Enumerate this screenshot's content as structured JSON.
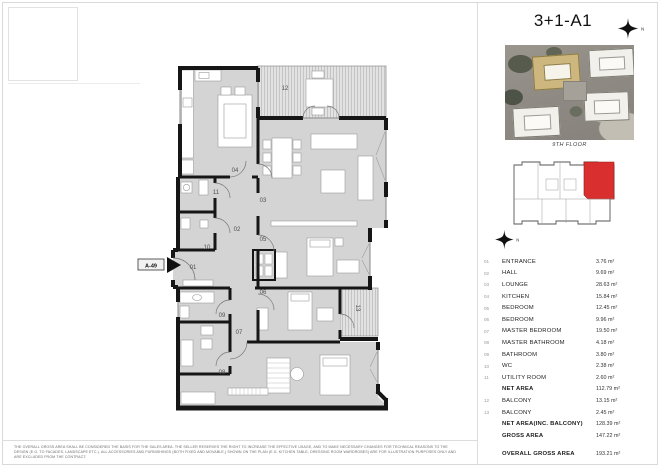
{
  "page": {
    "title": "3+1-A1",
    "floor_label": "9TH FLOOR",
    "north_label": "N",
    "unit_tag": "A-49",
    "disclaimer": "THE OVERALL GROSS AREA SHALL BE CONSIDERED THE BASIS FOR THE SALES AREA. THE SELLER RESERVES THE RIGHT TO INCREASE THE EFFECTIVE USAGE, AND TO MAKE NECESSARY CHANGES FOR TECHNICAL REASONS TO THE DESIGN (E.G. TO FACADES, LANDSCAPE ETC.). ALL ACCESSORIES AND FURNISHINGS (BOTH FIXED AND MOVABLE,) SHOWN ON THE PLAN (E.G. KITCHEN TABLE, DRESSING ROOM WARDROBES) ARE FOR ILLUSTRATION PURPOSES ONLY AND ARE EXCLUDED FROM THE CONTRACT."
  },
  "plan": {
    "room_numbers": [
      "01",
      "02",
      "03",
      "04",
      "05",
      "06",
      "07",
      "08",
      "09",
      "10",
      "11",
      "12",
      "13"
    ]
  },
  "colors": {
    "keyplan_unit_red": "#da2f2f",
    "site_highlight_yellow": "#cdb77e"
  },
  "table": {
    "rows": [
      {
        "num": "01",
        "label": "ENTRANCE",
        "value": "3.76 m²",
        "cls": ""
      },
      {
        "num": "02",
        "label": "HALL",
        "value": "9.69 m²",
        "cls": ""
      },
      {
        "num": "03",
        "label": "LOUNGE",
        "value": "28.63 m²",
        "cls": ""
      },
      {
        "num": "04",
        "label": "KITCHEN",
        "value": "15.84 m²",
        "cls": ""
      },
      {
        "num": "05",
        "label": "BEDROOM",
        "value": "12.45 m²",
        "cls": ""
      },
      {
        "num": "06",
        "label": "BEDROOM",
        "value": "9.96 m²",
        "cls": ""
      },
      {
        "num": "07",
        "label": "MASTER BEDROOM",
        "value": "19.50 m²",
        "cls": ""
      },
      {
        "num": "08",
        "label": "MASTER BATHROOM",
        "value": "4.18 m²",
        "cls": ""
      },
      {
        "num": "09",
        "label": "BATHROOM",
        "value": "3.80 m²",
        "cls": ""
      },
      {
        "num": "10",
        "label": "WC",
        "value": "2.38 m²",
        "cls": ""
      },
      {
        "num": "11",
        "label": "UTILITY ROOM",
        "value": "2.60 m²",
        "cls": ""
      },
      {
        "num": "",
        "label": "NET AREA",
        "value": "112.79 m²",
        "cls": "bold"
      },
      {
        "num": "12",
        "label": "BALCONY",
        "value": "13.15 m²",
        "cls": ""
      },
      {
        "num": "13",
        "label": "BALCONY",
        "value": "2.45 m²",
        "cls": ""
      },
      {
        "num": "",
        "label": "NET AREA(INC. BALCONY)",
        "value": "128.39 m²",
        "cls": "bold"
      },
      {
        "num": "",
        "label": "GROSS AREA",
        "value": "147.22 m²",
        "cls": "bold"
      },
      {
        "num": "",
        "label": "OVERALL GROSS AREA",
        "value": "193.21 m²",
        "cls": "bold gap"
      }
    ]
  }
}
